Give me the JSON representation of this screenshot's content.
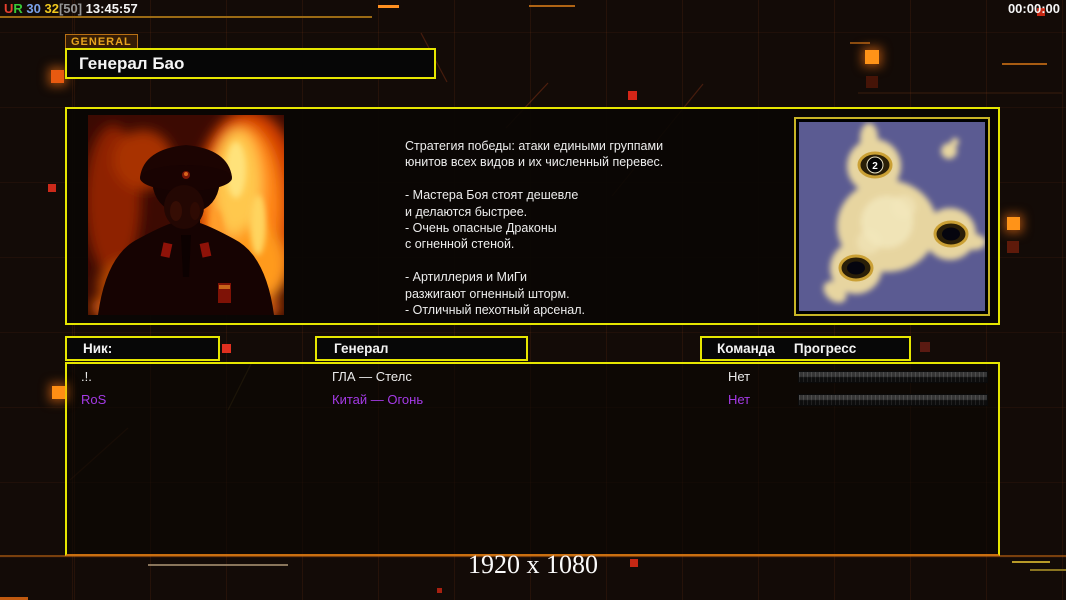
{
  "colors": {
    "accent_yellow": "#e6e600",
    "accent_orange": "#ff8e14",
    "purple": "#a43ae6",
    "map_water": "#5b5b92",
    "map_land": "#e7d5a0"
  },
  "status_bar": {
    "segments": [
      {
        "text": "U",
        "color": "#e8402e"
      },
      {
        "text": "R",
        "color": "#38cc38"
      },
      {
        "text": " 30 ",
        "color": "#7aa2ea"
      },
      {
        "text": "32",
        "color": "#f0c81e"
      },
      {
        "text": "[50]",
        "color": "#969696"
      },
      {
        "text": " 13:45:57",
        "color": "#f5f5f5"
      }
    ],
    "timer": "00:00:00"
  },
  "header": {
    "tag": "GENERAL",
    "title": "Генерал Бао"
  },
  "general_info": {
    "description": "Стратегия победы: атаки едиными группами\nюнитов всех видов и их численный перевес.\n\n- Мастера Боя стоят дешевле\nи делаются быстрее.\n- Очень опасные Драконы\nс огненной стеной.\n\n- Артиллерия и МиГи\nразжигают огненный шторм.\n- Отличный пехотный арсенал.",
    "minimap": {
      "start_marker": "2"
    }
  },
  "lobby": {
    "columns": {
      "nick": "Ник:",
      "general": "Генерал",
      "team": "Команда",
      "progress": "Прогресс"
    },
    "players": [
      {
        "nick": ".!.",
        "general": "ГЛА — Стелс",
        "team": "Нет",
        "color": "#ebebeb",
        "progress_percent": 0,
        "progress_width": "0%"
      },
      {
        "nick": "RoS",
        "general": "Китай — Огонь",
        "team": "Нет",
        "color": "#a43ae6",
        "progress_percent": 0,
        "progress_width": "0%"
      }
    ]
  },
  "footer": {
    "resolution": "1920 x 1080"
  }
}
